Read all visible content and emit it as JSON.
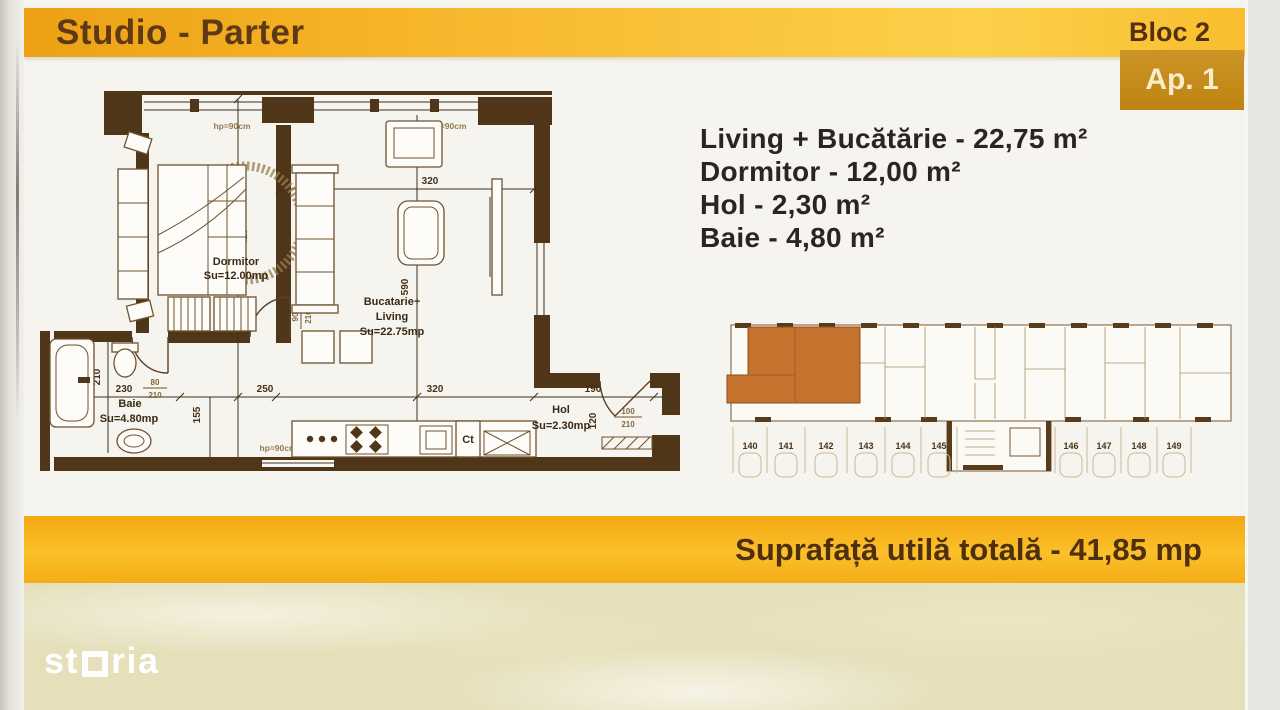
{
  "header": {
    "title": "Studio - Parter",
    "bloc_label": "Bloc 2",
    "apartment_label": "Ap. 1"
  },
  "room_list": {
    "items": [
      "Living + Bucătărie - 22,75 m²",
      "Dormitor - 12,00 m²",
      "Hol - 2,30 m²",
      "Baie - 4,80 m²"
    ]
  },
  "floor_plan": {
    "rooms": {
      "dormitor": {
        "name": "Dormitor",
        "area": "Su=12.00mp"
      },
      "living": {
        "line1": "Bucatarie+",
        "line2": "Living",
        "area": "Su=22.75mp"
      },
      "baie": {
        "name": "Baie",
        "area": "Su=4.80mp"
      },
      "hol": {
        "name": "Hol",
        "area": "Su=2.30mp"
      }
    },
    "dims": {
      "top": "320",
      "dorm_h": "425",
      "living_h": "590",
      "baie_w": "230",
      "dorm_w": "250",
      "living_w": "320",
      "hol_w": "190",
      "kitchen": "155",
      "baie_d": "210",
      "entry_d": "120"
    },
    "doors": {
      "dorm_w": "90",
      "dorm_h": "210",
      "baie_w": "80",
      "baie_h": "210",
      "entry_w": "100",
      "entry_h": "210"
    },
    "annotations": {
      "parapet": "hp=90cm",
      "boiler": "Ct"
    }
  },
  "site_plan": {
    "parking": [
      "140",
      "141",
      "142",
      "143",
      "144",
      "145",
      "146",
      "147",
      "148",
      "149"
    ]
  },
  "footer": {
    "total_area_label": "Suprafață utilă totală - 41,85 mp"
  },
  "watermark": {
    "brand_prefix": "st",
    "brand_suffix": "ria"
  },
  "colors": {
    "banner_gold": "#f3a81c",
    "banner_gold_light": "#fdd04a",
    "banner_text": "#5e3a14",
    "badge_bg": "#c58c1c",
    "badge_text": "#f7edc9",
    "plan_wall": "#503619",
    "highlight_unit": "#c4722d",
    "list_text": "#2b2420"
  }
}
